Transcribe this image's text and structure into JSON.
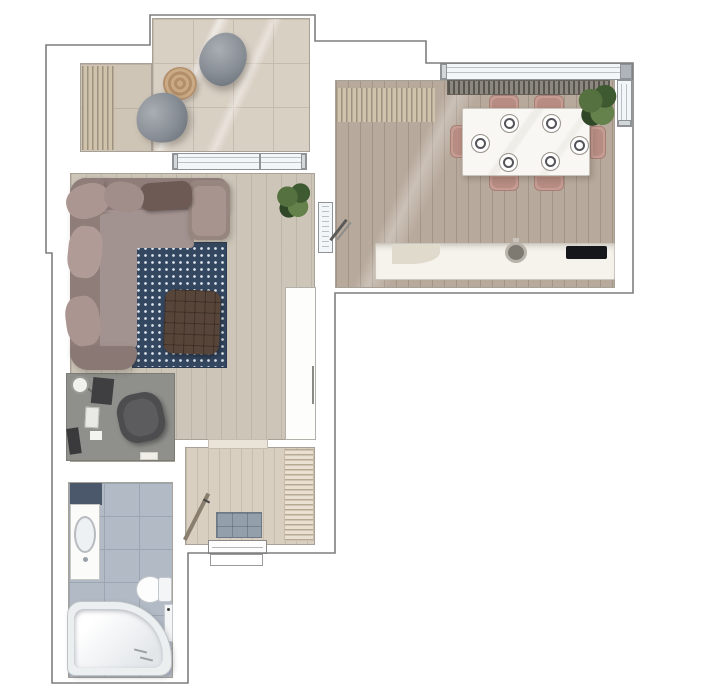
{
  "meta": {
    "type": "floor-plan-render",
    "description": "Top-down rendered floor plan of a one-bedroom apartment with balcony, living room, kitchen-dining room, hallway and bathroom",
    "canvas": {
      "width": 724,
      "height": 700,
      "background": "#ffffff"
    }
  },
  "palette": {
    "wall_outline": "#7f7f7f",
    "balcony_tile": "#d9d0c4",
    "living_floor": "#cdc5b8",
    "kitchen_floor": "#b7a99b",
    "hall_floor": "#d8cfc1",
    "bath_tile": "#b2bac5",
    "sofa": "#998784",
    "rug_navy": "#344761",
    "ottoman_brown": "#584539",
    "chair_rose": "#c59c92",
    "plant_green": "#4e6b3f",
    "window_glass": "#f3f6f8",
    "counter_white": "#f6f3ec",
    "worktop_dark": "#6a655d",
    "cooktop_black": "#15171b"
  },
  "rooms": [
    {
      "id": "balcony",
      "label": "balcony"
    },
    {
      "id": "living-room",
      "label": "living room"
    },
    {
      "id": "kitchen-dining",
      "label": "kitchen / dining room"
    },
    {
      "id": "hallway",
      "label": "hallway"
    },
    {
      "id": "bathroom",
      "label": "bathroom"
    }
  ],
  "furniture": {
    "balcony": [
      "bean bag x2",
      "round jute pouf",
      "striped outdoor mat"
    ],
    "living_room": [
      "corner sofa",
      "polka dot rug",
      "knitted ottoman",
      "desk",
      "office chair",
      "desk lamp",
      "monitor",
      "keyboard",
      "tall white cabinet",
      "potted plant"
    ],
    "kitchen_dining": [
      "dining table",
      "dining chair x6",
      "place setting x6",
      "kitchen counter",
      "round sink",
      "cooktop",
      "radiator",
      "striped mat",
      "potted plant"
    ],
    "hallway": [
      "shoe cabinet",
      "striped runner rug",
      "entrance door",
      "interior door",
      "doormat"
    ],
    "bathroom": [
      "vanity with oval basin",
      "dark shelf unit",
      "toilet",
      "corner bathtub",
      "wall panel"
    ]
  },
  "dining": {
    "plates": [
      [
        507,
        121
      ],
      [
        549,
        121
      ],
      [
        478,
        141
      ],
      [
        577,
        143
      ],
      [
        506,
        160
      ],
      [
        548,
        159
      ]
    ]
  }
}
